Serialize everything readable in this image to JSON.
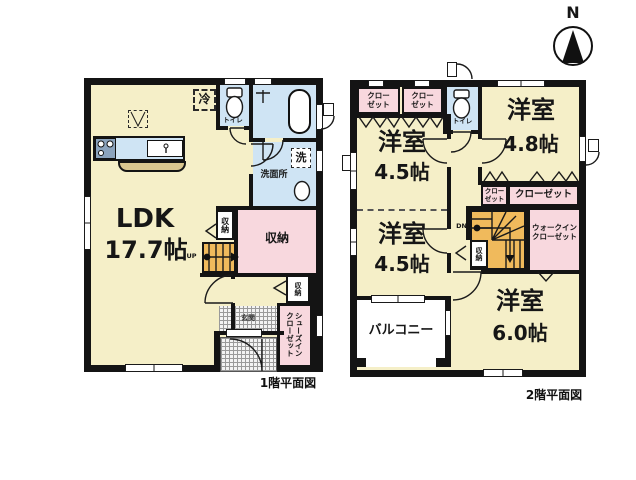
{
  "colors": {
    "room": "#f5efc8",
    "closet": "#f8d8de",
    "wet": "#cfe4f4",
    "stairs": "#f0ba5c",
    "counter": "#d9c68f",
    "wall": "#141414",
    "hatch": "#9a9a9a"
  },
  "compass": {
    "north": "N"
  },
  "floor1": {
    "caption": "1階平面図",
    "ldk_name": "LDK",
    "ldk_size": "17.7帖",
    "fridge": "冷",
    "toilet": "トイレ",
    "washer": "洗",
    "washroom": "洗面所",
    "closet_upper": "収納",
    "storage": "収納",
    "closet_hall": "収納",
    "up": "UP",
    "entrance": "玄関",
    "shoe_closet": "シューズイン\nクローゼット"
  },
  "floor2": {
    "caption": "2階平面図",
    "closet_a": "クロー\nゼット",
    "closet_b": "クロー\nゼット",
    "toilet": "トイレ",
    "room_nw_name": "洋室",
    "room_nw_size": "4.5帖",
    "room_ne_name": "洋室",
    "room_ne_size": "4.8帖",
    "room_sw_name": "洋室",
    "room_sw_size": "4.5帖",
    "room_se_name": "洋室",
    "room_se_size": "6.0帖",
    "closet_c": "クロー\nゼット",
    "closet_d": "クローゼット",
    "wic": "ウォークイン\nクローゼット",
    "closet_stairs": "収納",
    "dn": "DN",
    "balcony": "バルコニー"
  }
}
